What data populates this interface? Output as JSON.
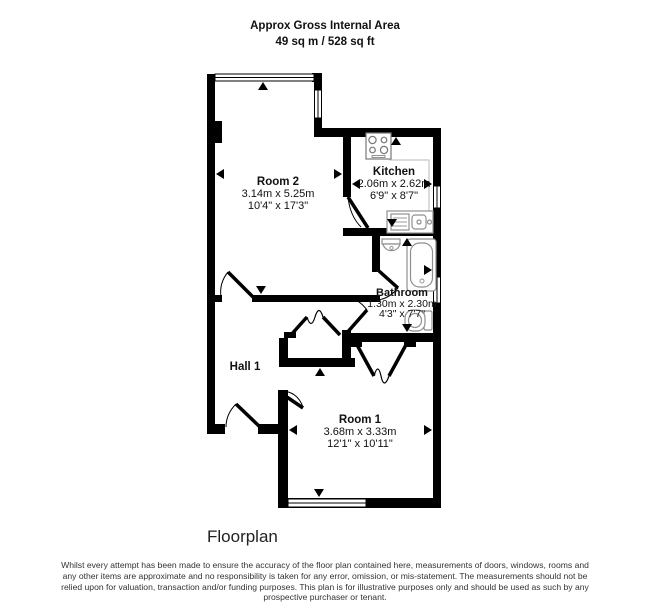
{
  "header": {
    "line1": "Approx Gross Internal Area",
    "line2": "49 sq m / 528 sq ft"
  },
  "rooms": {
    "room2": {
      "name": "Room 2",
      "metric": "3.14m x 5.25m",
      "imperial": "10'4\" x 17'3\""
    },
    "kitchen": {
      "name": "Kitchen",
      "metric": "2.06m x 2.62m",
      "imperial": "6'9\" x 8'7\""
    },
    "bathroom": {
      "name": "Bathroom",
      "metric": "1.30m x 2.30m",
      "imperial": "4'3\" x 7'7\""
    },
    "hall": {
      "name": "Hall 1"
    },
    "room1": {
      "name": "Room 1",
      "metric": "3.68m x 3.33m",
      "imperial": "12'1\" x 10'11\""
    }
  },
  "footer": {
    "caption": "Floorplan",
    "disclaimer": "Whilst every attempt has been made to ensure the accuracy of the floor plan contained here, measurements of doors, windows, rooms and any other items are approximate and no responsibility is taken for any error, omission, or mis-statement. The measurements should not be relied upon for valuation, transaction and/or funding purposes. This plan is for illustrative purposes only and should be used as such by any prospective purchaser or tenant."
  },
  "colors": {
    "wall": "#000000",
    "fixture": "#8f8f8f",
    "counter": "#c5c5c5"
  }
}
